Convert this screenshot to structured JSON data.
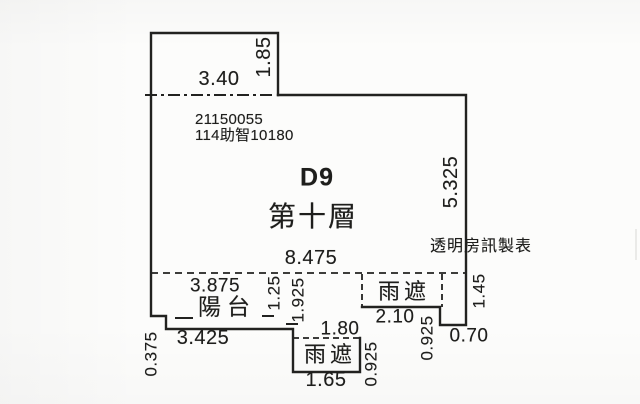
{
  "plan": {
    "unit_id": "D9",
    "floor_label": "第十層",
    "registration": {
      "line1": "21150055",
      "line2": "114助智10180"
    },
    "credit": "透明房訊製表",
    "rooms": {
      "balcony": "陽台",
      "canopy_bottom": "雨遮",
      "canopy_right": "雨遮"
    },
    "dims": {
      "top_width": "3.40",
      "top_height": "1.85",
      "right_height": "5.325",
      "main_width": "8.475",
      "balcony_top_width": "3.875",
      "balcony_bottom_width": "3.425",
      "balcony_left_offset": "0.375",
      "balcony_right_height": "1.25",
      "balcony_to_canopy_height": "1.925",
      "canopy_bottom_top_width": "1.80",
      "canopy_bottom_width": "1.65",
      "canopy_bottom_height": "0.925",
      "canopy_right_width": "2.10",
      "canopy_right_height": "0.925",
      "right_step_width": "0.70",
      "right_lower_height": "1.45"
    },
    "colors": {
      "line": "#222220",
      "text": "#1e1e1c"
    }
  }
}
